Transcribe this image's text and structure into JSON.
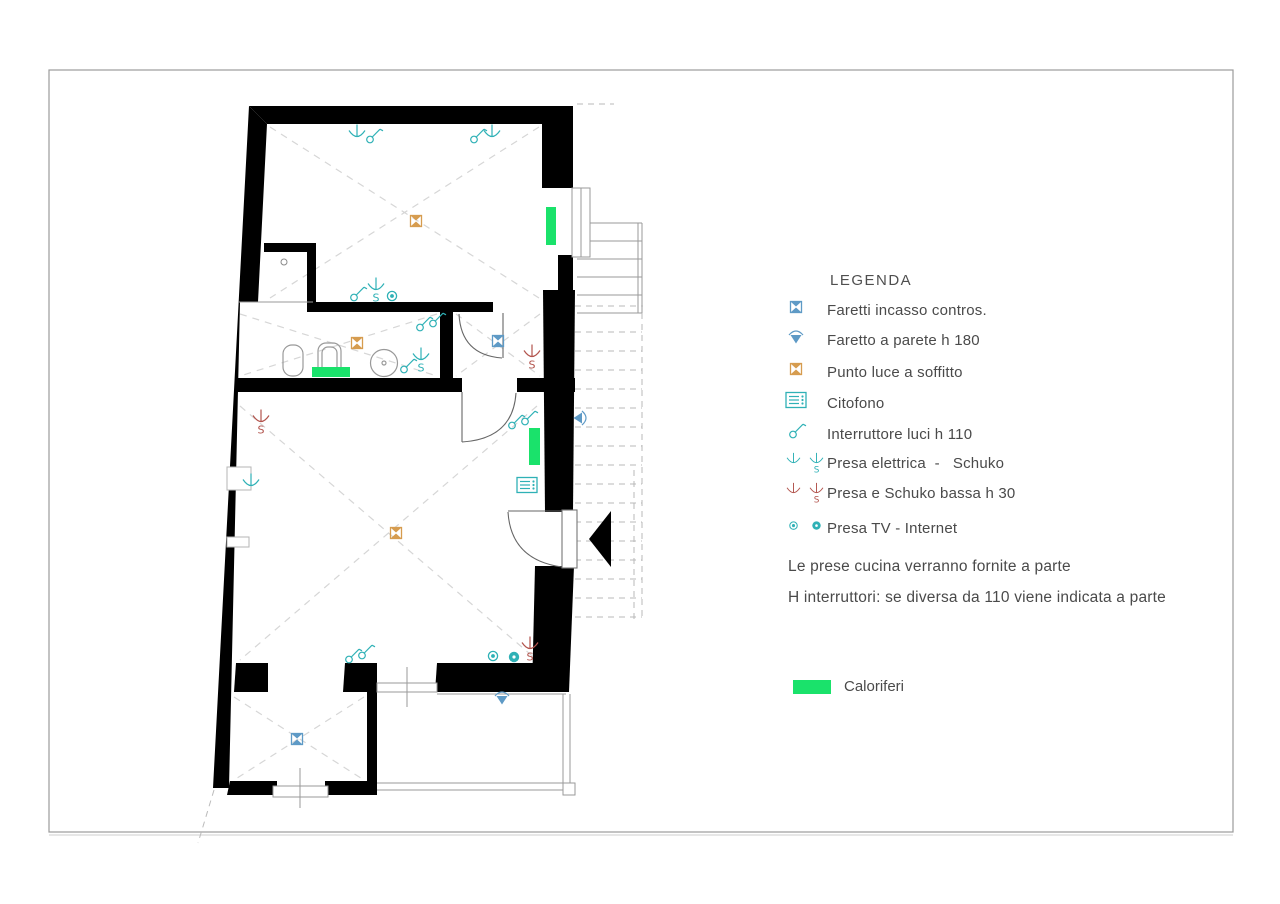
{
  "legend": {
    "title": "LEGENDA",
    "items": [
      {
        "icons": [
          "faretti-incasso"
        ],
        "label": "Faretti incasso contros."
      },
      {
        "icons": [
          "faretto-parete"
        ],
        "label": "Faretto a parete h 180"
      },
      {
        "icons": [
          "punto-luce"
        ],
        "label": "Punto luce a soffitto"
      },
      {
        "icons": [
          "citofono"
        ],
        "label": "Citofono"
      },
      {
        "icons": [
          "interruttore"
        ],
        "label": "Interruttore luci h 110"
      },
      {
        "icons": [
          "presa",
          "presa-s"
        ],
        "label": "Presa elettrica  -   Schuko"
      },
      {
        "icons": [
          "presa-bassa",
          "schuko-bassa"
        ],
        "label": "Presa e Schuko bassa h 30"
      },
      {
        "icons": [
          "presa-tv",
          "presa-internet"
        ],
        "label": "Presa TV - Internet"
      }
    ],
    "notes": [
      "Le prese cucina verranno fornite a parte",
      "H interruttori: se diversa da 110 viene indicata a parte"
    ],
    "caloriferi_label": "Caloriferi"
  },
  "plan": {
    "colors": {
      "teal": "#2fb1b6",
      "blue": "#5e9ac6",
      "orange": "#d69c4f",
      "red": "#b2544d",
      "green": "#1ae26b"
    },
    "symbols": [
      {
        "type": "presa",
        "x": 357,
        "y": 134
      },
      {
        "type": "interruttore",
        "x": 373,
        "y": 136
      },
      {
        "type": "interruttore",
        "x": 477,
        "y": 136
      },
      {
        "type": "presa",
        "x": 492,
        "y": 134
      },
      {
        "type": "punto-luce",
        "x": 416,
        "y": 221
      },
      {
        "type": "interruttore",
        "x": 357,
        "y": 294
      },
      {
        "type": "presa-s",
        "x": 376,
        "y": 287
      },
      {
        "type": "presa-tv",
        "x": 392,
        "y": 296
      },
      {
        "type": "interruttore2",
        "x": 430,
        "y": 322
      },
      {
        "type": "punto-luce",
        "x": 357,
        "y": 343
      },
      {
        "type": "interruttore",
        "x": 407,
        "y": 366
      },
      {
        "type": "presa-s",
        "x": 421,
        "y": 357
      },
      {
        "type": "faretti-incasso",
        "x": 498,
        "y": 341
      },
      {
        "type": "schuko-bassa",
        "x": 532,
        "y": 354
      },
      {
        "type": "schuko-bassa",
        "x": 261,
        "y": 419
      },
      {
        "type": "presa",
        "x": 251,
        "y": 483
      },
      {
        "type": "punto-luce",
        "x": 396,
        "y": 533
      },
      {
        "type": "interruttore2",
        "x": 522,
        "y": 420
      },
      {
        "type": "citofono",
        "x": 527,
        "y": 485
      },
      {
        "type": "faretto-parete",
        "x": 580,
        "y": 418,
        "rot": 90
      },
      {
        "type": "presa-tv",
        "x": 493,
        "y": 656
      },
      {
        "type": "presa-internet",
        "x": 514,
        "y": 657
      },
      {
        "type": "schuko-bassa",
        "x": 530,
        "y": 646
      },
      {
        "type": "interruttore2",
        "x": 359,
        "y": 654
      },
      {
        "type": "faretti-incasso",
        "x": 297,
        "y": 739
      },
      {
        "type": "faretto-parete",
        "x": 502,
        "y": 698
      }
    ],
    "radiators": [
      {
        "x": 546,
        "y": 207,
        "w": 10,
        "h": 38
      },
      {
        "x": 312,
        "y": 367,
        "w": 38,
        "h": 10
      },
      {
        "x": 529,
        "y": 428,
        "w": 11,
        "h": 37
      }
    ]
  }
}
